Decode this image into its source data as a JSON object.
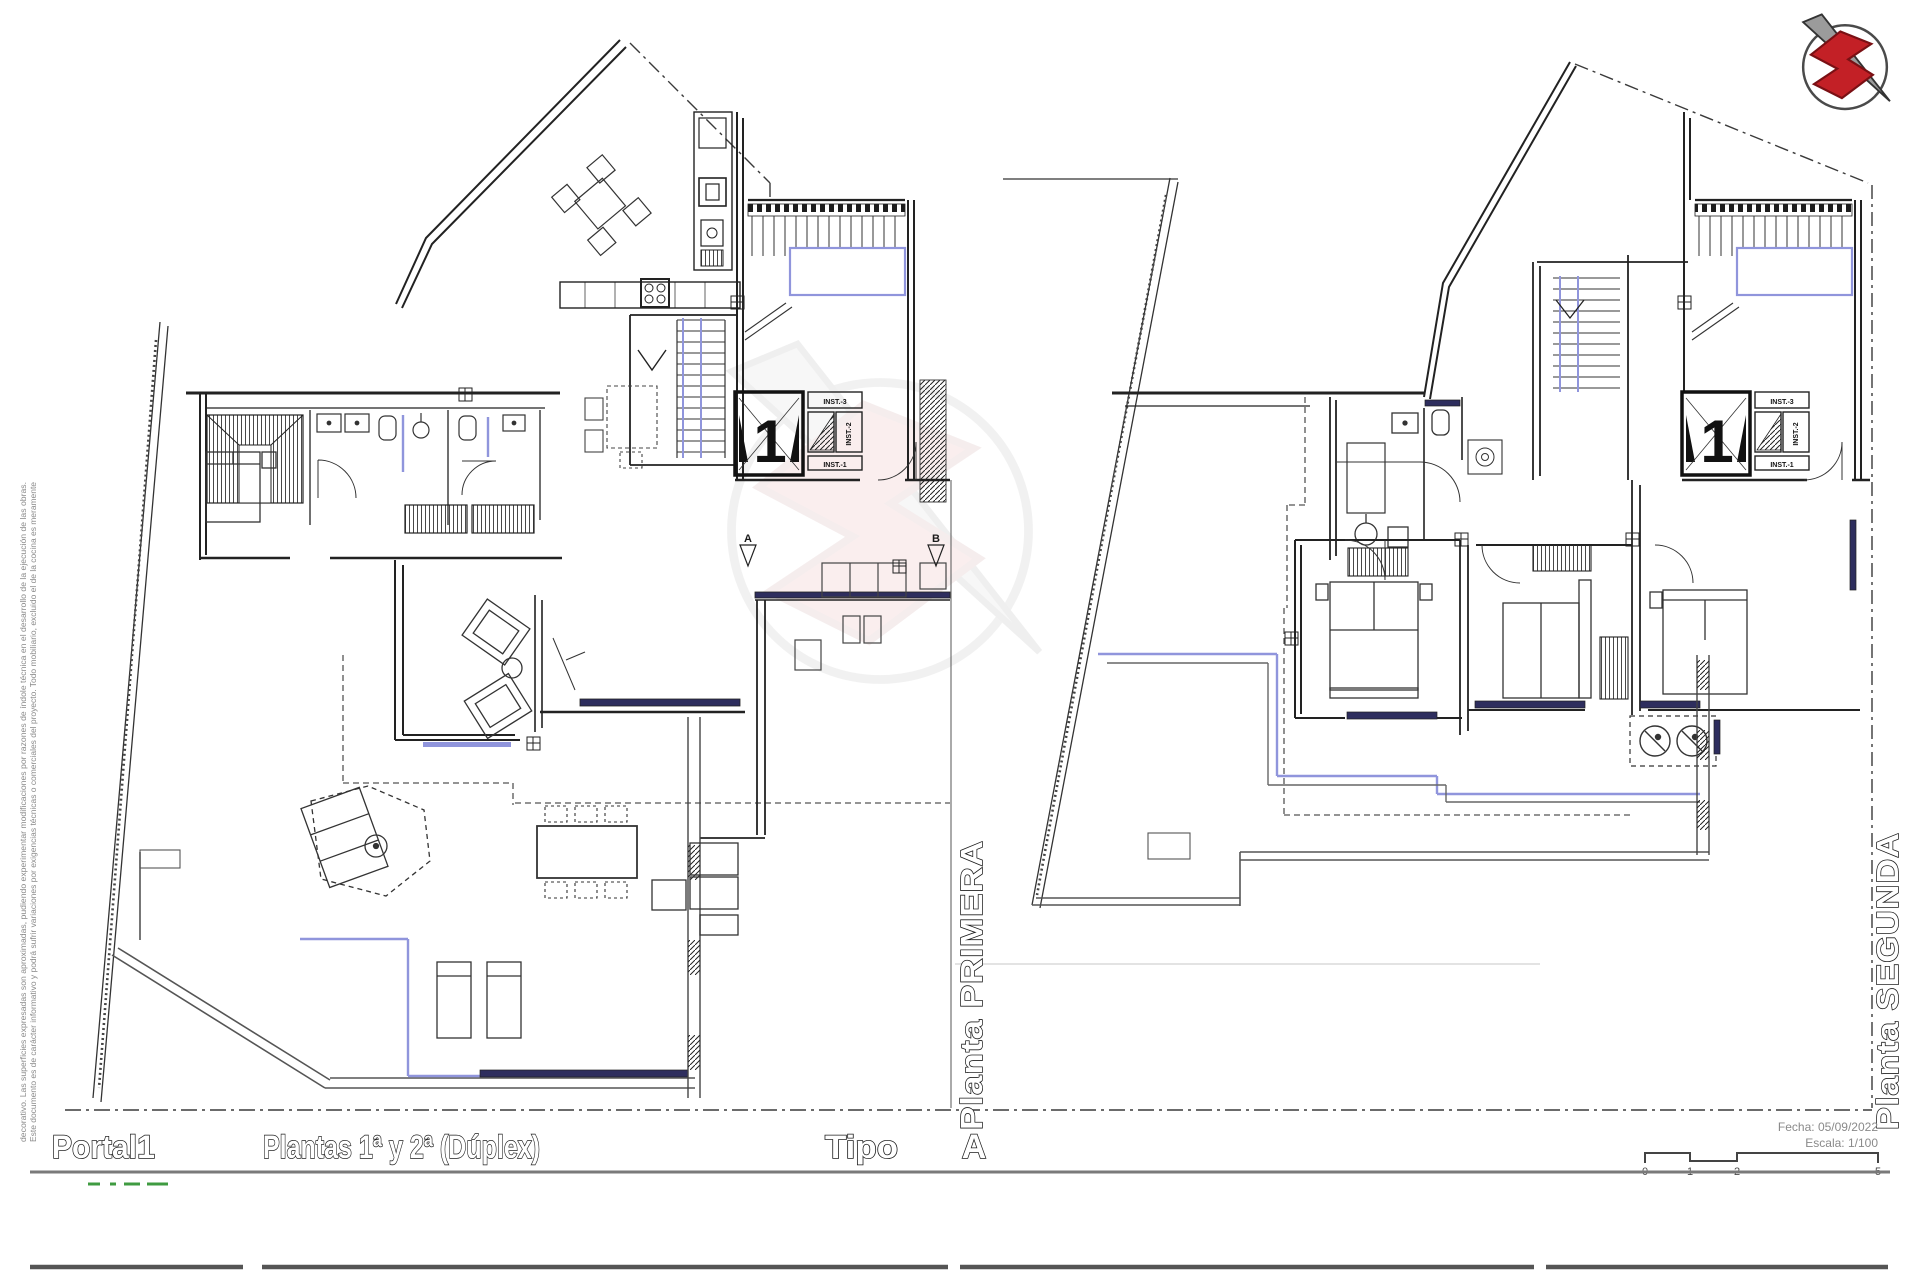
{
  "sheet": {
    "disclaimer_line1": "Este documento es de carácter informativo y podrá sufrir variaciones por exigencias técnicas o comerciales del proyecto. Todo mobiliario, excluido el de la cocina es meramente",
    "disclaimer_line2": "decorativo. Las superficies expresadas son aproximadas, pudiendo experimentar modificaciones por razones de índole técnica en el desarrollo de la ejecución de las obras."
  },
  "plans": [
    {
      "label": "Planta PRIMERA",
      "elevator": "1",
      "inst": [
        "INST.-3",
        "INST.-2",
        "INST.-1"
      ],
      "door_markers": [
        "A",
        "B"
      ]
    },
    {
      "label": "Planta SEGUNDA",
      "elevator": "1",
      "inst": [
        "INST.-3",
        "INST.-2",
        "INST.-1"
      ]
    }
  ],
  "title_block": {
    "portal_label": "Portal",
    "portal_value": "1",
    "plantas_label": "Plantas 1ª y 2ª (Dúplex)",
    "tipo_label": "Tipo",
    "tipo_value": "A",
    "fecha": "Fecha: 05/09/2022",
    "escala": "Escala: 1/100",
    "scale_ticks": [
      "0",
      "1",
      "2",
      "5"
    ]
  },
  "colors": {
    "accent_blue": "#9095dc",
    "window_navy": "#2e2e5e",
    "logo_red": "#c32026",
    "line": "#262626"
  }
}
